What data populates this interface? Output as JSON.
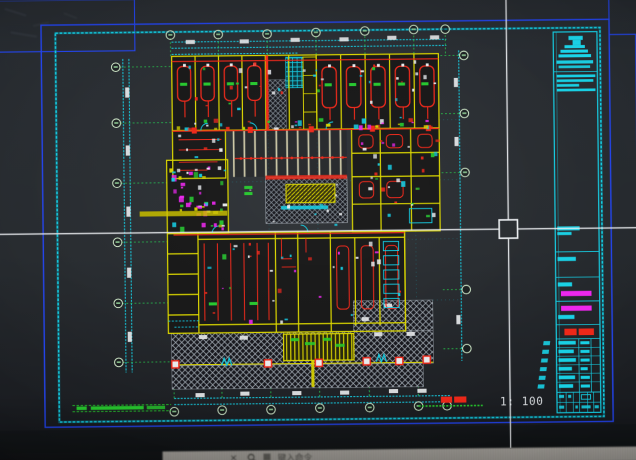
{
  "app": {
    "name": "cad-viewport",
    "command_bar": {
      "close_label": "✕",
      "search_icon": "magnifier-icon",
      "prompt_text": "键入命令"
    }
  },
  "drawing": {
    "sheet_type": "architectural-floor-plan",
    "scale_label": "1: 100",
    "colors": {
      "frame_blue": "#2543de",
      "sheet_cyan": "#1fc8dc",
      "wall_yellow": "#d9d400",
      "pipe_red": "#e1291b",
      "fixture_magenta": "#e229e2",
      "note_green": "#2ec434",
      "dim_white": "#e8eaec"
    }
  }
}
